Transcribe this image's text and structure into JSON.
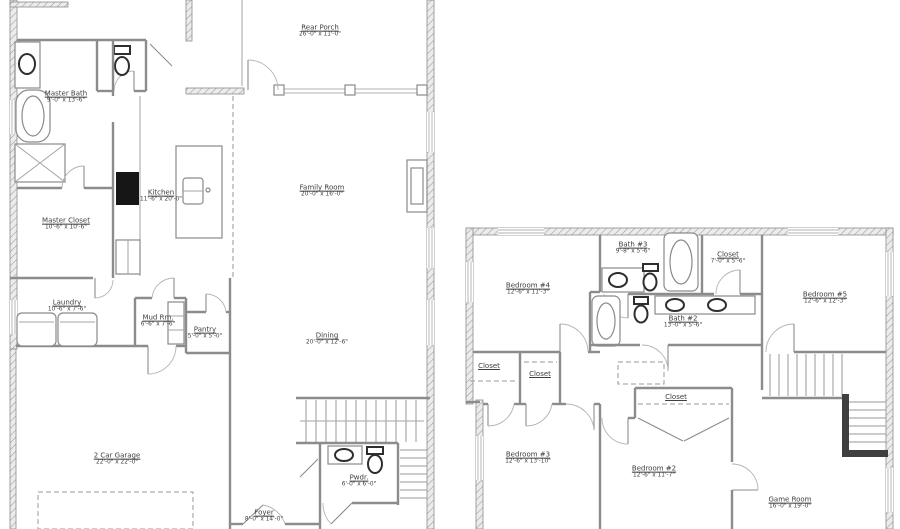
{
  "document": {
    "type": "floor-plan-drawing",
    "colors": {
      "background": "#ffffff",
      "line": "#8c8c8c",
      "fixture_dark": "#2e2e2e",
      "text": "#3d3d3d"
    }
  },
  "first_floor": {
    "rooms": [
      {
        "label": "Rear Porch",
        "dims": "26'-0\" x 11'-0\""
      },
      {
        "label": "Master Bath",
        "dims": "9'-0\" x 13'-6\""
      },
      {
        "label": "Kitchen",
        "dims": "11'-6\" x 20'-0\""
      },
      {
        "label": "Family Room",
        "dims": "20'-0\" x 16'-0\""
      },
      {
        "label": "Master Closet",
        "dims": "10'-6\" x 10'-6\""
      },
      {
        "label": "Laundry",
        "dims": "10'-6\" x 7'-6\""
      },
      {
        "label": "Mud Rm.",
        "dims": "6'-6\" x 7'-6\""
      },
      {
        "label": "Pantry",
        "dims": "5'-0\" x 5'-0\""
      },
      {
        "label": "Dining",
        "dims": "20'-0\" x 12'-6\""
      },
      {
        "label": "2 Car Garage",
        "dims": "22'-0\" x 22'-0\""
      },
      {
        "label": "Pwdr.",
        "dims": "6'-0\" x 6'-0\""
      },
      {
        "label": "Foyer",
        "dims": "8'-0\" x 14'-0\""
      }
    ]
  },
  "second_floor": {
    "rooms": [
      {
        "label": "Bath #3",
        "dims": "9'-8\" x 5'-6\""
      },
      {
        "label": "Closet",
        "dims": "7'-0\" x 5'-6\""
      },
      {
        "label": "Bedroom #4",
        "dims": "12'-6\" x 11'-3\""
      },
      {
        "label": "Bedroom #5",
        "dims": "12'-6\" x 12'-3\""
      },
      {
        "label": "Bath #2",
        "dims": "13'-0\" x 5'-6\""
      },
      {
        "label": "Closet"
      },
      {
        "label": "Closet"
      },
      {
        "label": "Closet"
      },
      {
        "label": "Bedroom #3",
        "dims": "12'-6\" x 13'-10\""
      },
      {
        "label": "Bedroom #2",
        "dims": "12'-6\" x 11'-7\""
      },
      {
        "label": "Game Room",
        "dims": "16'-0\" x 19'-0\""
      }
    ]
  }
}
